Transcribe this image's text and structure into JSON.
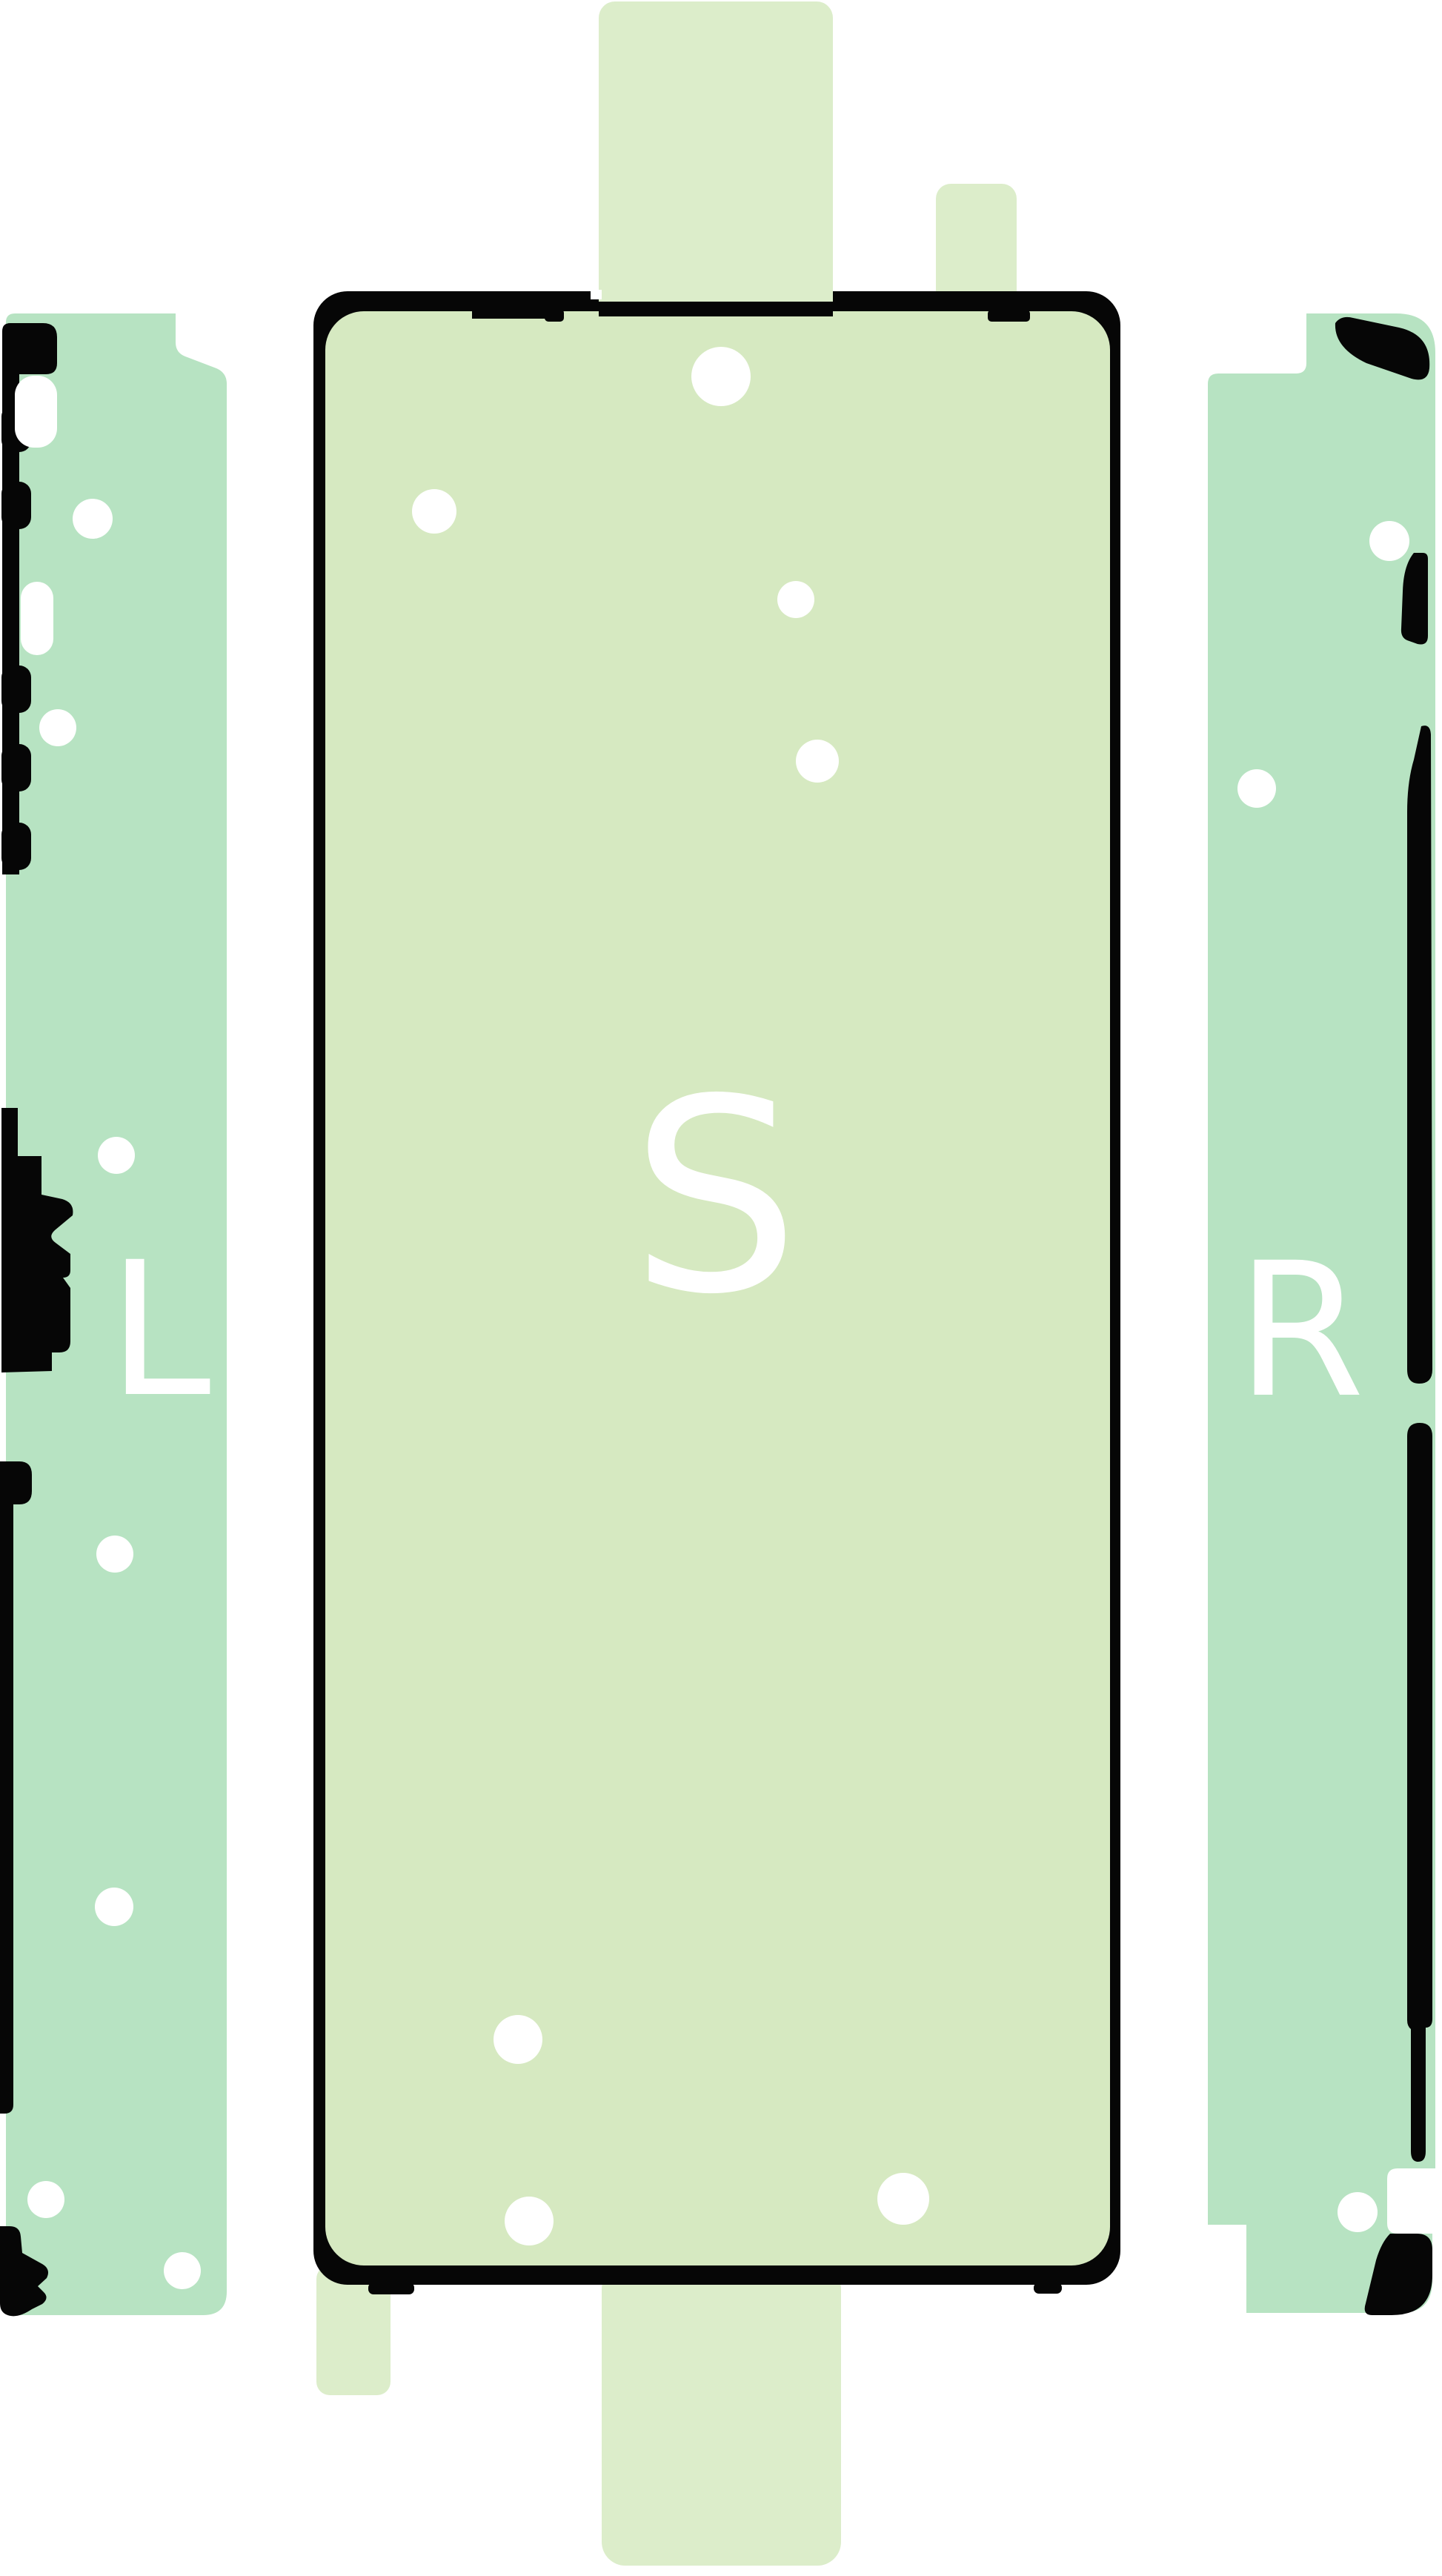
{
  "labels": {
    "left_rail": "L",
    "screen_sticker": "S",
    "right_rail": "R"
  },
  "colors": {
    "background": "#ffffff",
    "rail_mint": "#b7e3c2",
    "sticker_green": "#d6e9c1",
    "tab_green": "#dcedca",
    "outline_black": "#060606",
    "hole_white": "#ffffff",
    "label_white": "#ffffff"
  }
}
